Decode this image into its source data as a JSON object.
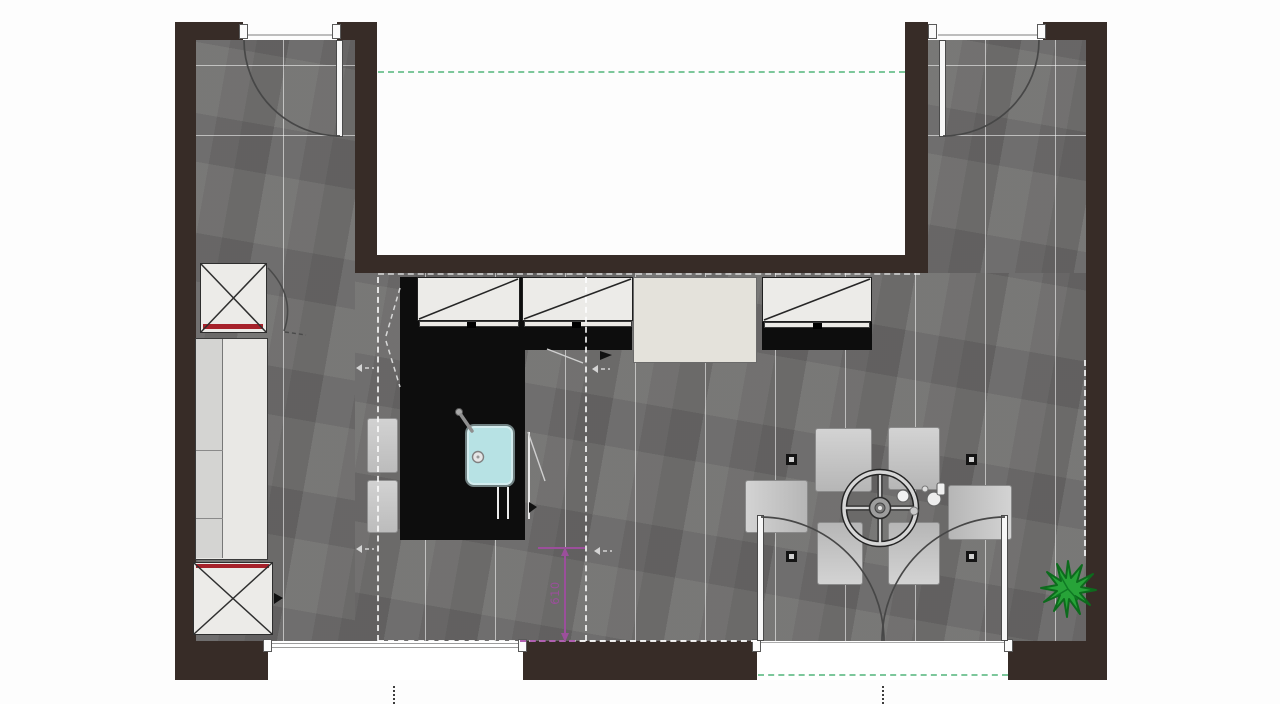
{
  "plan": {
    "dimension_label": "610",
    "symbols": {
      "plant": "plant-star-symbol",
      "door_swing": "door-swing-arc",
      "appliance_cross": "appliance-x-symbol",
      "wall_cabinet_diagonal": "wall-cabinet-diagonal-symbol",
      "table": "round-dining-table-symbol",
      "sink": "kitchen-sink-symbol"
    },
    "colors": {
      "wall": "#372c27",
      "floor": "#6d6c6b",
      "grout": "#ffffff",
      "counter": "#0d0d0d",
      "cabinet": "#ecebe8",
      "pantry_unit": "#e4e2db",
      "sink_fill": "#b7e2e4",
      "appliance_accent_red": "#a6212a",
      "chair": "#c6c6c6",
      "plant_green": "#27a338",
      "guide_green": "#7cc79b",
      "dimension_purple": "#9b4f9b"
    },
    "counts": {
      "dining_chairs": 6,
      "bar_stools": 2,
      "wall_cabinets": 3,
      "swing_doors": 2,
      "french_door_leaves": 2,
      "windows": 1,
      "plants": 1
    }
  }
}
